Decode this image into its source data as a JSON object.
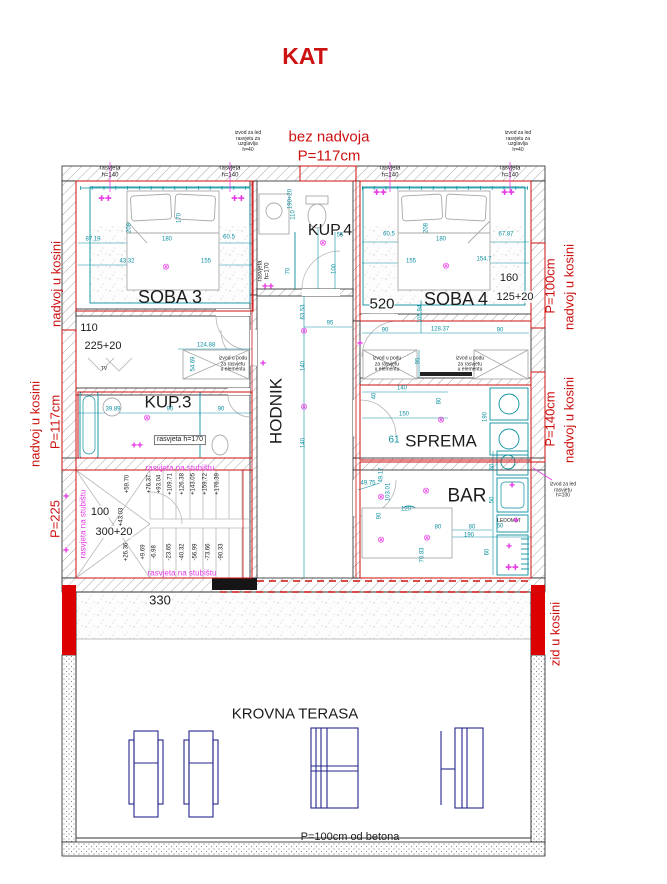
{
  "title": "KAT",
  "colors": {
    "red": "#cc1111",
    "magenta": "#e63ce6",
    "teal": "#0b8fa0",
    "navy": "#26268c",
    "black": "#1c1c1c",
    "gray": "#8c8c8c"
  },
  "icon_glyphs": {
    "ceiling": "⊗",
    "lamp": "✚✚",
    "led": "✚"
  },
  "labels": [
    {
      "name": "plan-title",
      "text": "KAT",
      "x": 305,
      "y": 57,
      "s": 23,
      "c": "red",
      "w": 1
    },
    {
      "name": "bez-nadvoja-label",
      "text": "bez nadvoja",
      "x": 329,
      "y": 138,
      "s": 15,
      "c": "red"
    },
    {
      "name": "bez-nadvoja-height",
      "text": "P=117cm",
      "x": 329,
      "y": 157,
      "s": 15,
      "c": "red"
    },
    {
      "name": "nadvoj-left-upper",
      "text": "nadvoj u kosini",
      "x": 57,
      "y": 284,
      "rot": -90,
      "s": 13,
      "c": "red"
    },
    {
      "name": "nadvoj-left-mid",
      "text": "nadvoj u kosini",
      "x": 36,
      "y": 424,
      "rot": -90,
      "s": 13,
      "c": "red"
    },
    {
      "name": "nadvoj-left-mid-height",
      "text": "P=117cm",
      "x": 56,
      "y": 422,
      "rot": -90,
      "s": 13,
      "c": "red"
    },
    {
      "name": "p225-label",
      "text": "P=225",
      "x": 56,
      "y": 519,
      "rot": -90,
      "s": 13,
      "c": "red"
    },
    {
      "name": "nadvoj-right-upper",
      "text": "nadvoj u kosini",
      "x": 570,
      "y": 287,
      "rot": -90,
      "s": 13,
      "c": "red"
    },
    {
      "name": "nadvoj-right-upper-height",
      "text": "P=100cm",
      "x": 551,
      "y": 286,
      "rot": -90,
      "s": 13,
      "c": "red"
    },
    {
      "name": "nadvoj-right-mid",
      "text": "nadvoj u kosini",
      "x": 570,
      "y": 420,
      "rot": -90,
      "s": 13,
      "c": "red"
    },
    {
      "name": "nadvoj-right-mid-height",
      "text": "P=140cm",
      "x": 551,
      "y": 419,
      "rot": -90,
      "s": 13,
      "c": "red"
    },
    {
      "name": "zid-u-kosini-label",
      "text": "zid u kosini",
      "x": 556,
      "y": 634,
      "rot": -90,
      "s": 13,
      "c": "red"
    },
    {
      "name": "room-soba3",
      "text": "SOBA 3",
      "x": 170,
      "y": 297,
      "s": 18
    },
    {
      "name": "room-kup4",
      "text": "KUP.4",
      "x": 330,
      "y": 231,
      "s": 16
    },
    {
      "name": "room-soba4",
      "text": "SOBA 4",
      "x": 456,
      "y": 299,
      "s": 18
    },
    {
      "name": "room-hodnik",
      "text": "HODNIK",
      "x": 276,
      "y": 411,
      "rot": -90,
      "s": 17
    },
    {
      "name": "room-kup3",
      "text": "KUP.3",
      "x": 168,
      "y": 402,
      "s": 17
    },
    {
      "name": "room-sprema",
      "text": "SPREMA",
      "x": 441,
      "y": 441,
      "s": 17
    },
    {
      "name": "room-bar",
      "text": "BAR",
      "x": 467,
      "y": 496,
      "s": 19
    },
    {
      "name": "room-krovna-terasa",
      "text": "KROVNA TERASA",
      "x": 295,
      "y": 715,
      "s": 15
    },
    {
      "name": "terrace-note",
      "text": "P=100cm od betona",
      "x": 350,
      "y": 837,
      "s": 11
    },
    {
      "name": "dim-520",
      "text": "520",
      "x": 382,
      "y": 305,
      "s": 15,
      "bg": 1
    },
    {
      "name": "dim-330",
      "text": "330",
      "x": 160,
      "y": 601,
      "s": 13,
      "bg": 1
    },
    {
      "name": "dim-110",
      "text": "110",
      "x": 89,
      "y": 328,
      "s": 11,
      "bg": 1
    },
    {
      "name": "dim-225-20",
      "text": "225+20",
      "x": 103,
      "y": 346,
      "s": 11,
      "bg": 1
    },
    {
      "name": "dim-100",
      "text": "100",
      "x": 100,
      "y": 512,
      "s": 11,
      "bg": 1
    },
    {
      "name": "dim-300-20",
      "text": "300+20",
      "x": 114,
      "y": 532,
      "s": 11,
      "bg": 1
    },
    {
      "name": "dim-160",
      "text": "160",
      "x": 509,
      "y": 278,
      "s": 11,
      "bg": 1
    },
    {
      "name": "dim-125-20",
      "text": "125+20",
      "x": 515,
      "y": 297,
      "s": 11,
      "bg": 1
    },
    {
      "name": "tv-label",
      "text": "TV",
      "x": 104,
      "y": 370,
      "s": 5
    },
    {
      "name": "ledomat-label",
      "text": "LEDOMAT",
      "x": 509,
      "y": 522,
      "s": 5
    },
    {
      "name": "rasvjeta-140-1",
      "text": "rasvjeta\nh=140",
      "x": 110,
      "y": 172,
      "s": 6
    },
    {
      "name": "rasvjeta-140-2",
      "text": "rasvjeta\nh=140",
      "x": 230,
      "y": 172,
      "s": 6
    },
    {
      "name": "rasvjeta-140-3",
      "text": "rasvjeta\nh=140",
      "x": 390,
      "y": 172,
      "s": 6
    },
    {
      "name": "rasvjeta-140-4",
      "text": "rasvjeta\nh=140",
      "x": 510,
      "y": 172,
      "s": 6
    },
    {
      "name": "rasvjeta-170-kup3",
      "text": "rasvjeta h=170",
      "x": 180,
      "y": 440,
      "s": 7,
      "box": 1
    },
    {
      "name": "rasvjeta-170-kup4",
      "text": "rasvjeta\nh=170",
      "x": 264,
      "y": 271,
      "rot": -90,
      "s": 6
    },
    {
      "name": "izvod-led-uzglavlje-left",
      "text": "izvod za led\nrasvjetu za\nuzglavlja\nh=40",
      "x": 248,
      "y": 142,
      "s": 5
    },
    {
      "name": "izvod-led-uzglavlje-right",
      "text": "izvod za led\nrasvjetu za\nuzglavlja\nh=40",
      "x": 518,
      "y": 142,
      "s": 5
    },
    {
      "name": "izvod-led-h100",
      "text": "izvod za led\nrasvjetu\nh=100",
      "x": 563,
      "y": 491,
      "s": 5
    },
    {
      "name": "izvod-podu-kup3",
      "text": "izvod u podu\nza rasvjetu\nu elementu",
      "x": 233,
      "y": 365,
      "s": 5
    },
    {
      "name": "izvod-podu-soba4-left",
      "text": "izvod u podu\nza rasvjetu\nu elementu",
      "x": 387,
      "y": 365,
      "s": 5
    },
    {
      "name": "izvod-podu-soba4-right",
      "text": "izvod u podu\nza rasvjetu\nu elementu",
      "x": 470,
      "y": 365,
      "s": 5
    },
    {
      "name": "rasvjeta-stubiste-top",
      "text": "rasvjeta na stubištu",
      "x": 180,
      "y": 469,
      "s": 8,
      "c": "magenta"
    },
    {
      "name": "rasvjeta-stubiste-bottom",
      "text": "rasvjeta na stubištu",
      "x": 182,
      "y": 574,
      "s": 8,
      "c": "magenta"
    },
    {
      "name": "rasvjeta-stubiste-side",
      "text": "rasvjeta na stubištu",
      "x": 84,
      "y": 524,
      "rot": -90,
      "s": 8,
      "c": "magenta"
    },
    {
      "name": "stair-elev-top-1",
      "text": "+59.70",
      "x": 128,
      "y": 484,
      "rot": -90,
      "s": 6
    },
    {
      "name": "stair-elev-top-2",
      "text": "+76.37",
      "x": 150,
      "y": 484,
      "rot": -90,
      "s": 6
    },
    {
      "name": "stair-elev-top-3",
      "text": "+93.04",
      "x": 160,
      "y": 484,
      "rot": -90,
      "s": 6
    },
    {
      "name": "stair-elev-top-4",
      "text": "+109.71",
      "x": 171,
      "y": 484,
      "rot": -90,
      "s": 6
    },
    {
      "name": "stair-elev-top-5",
      "text": "+126.38",
      "x": 183,
      "y": 484,
      "rot": -90,
      "s": 6
    },
    {
      "name": "stair-elev-top-6",
      "text": "+143.05",
      "x": 194,
      "y": 484,
      "rot": -90,
      "s": 6
    },
    {
      "name": "stair-elev-top-7",
      "text": "+159.72",
      "x": 206,
      "y": 484,
      "rot": -90,
      "s": 6
    },
    {
      "name": "stair-elev-top-8",
      "text": "+176.39",
      "x": 218,
      "y": 484,
      "rot": -90,
      "s": 6
    },
    {
      "name": "stair-elev-mid",
      "text": "+43.03",
      "x": 122,
      "y": 517,
      "rot": -90,
      "s": 6
    },
    {
      "name": "stair-elev-bot-1",
      "text": "+26.36",
      "x": 127,
      "y": 552,
      "rot": -90,
      "s": 6
    },
    {
      "name": "stair-elev-bot-2",
      "text": "+9.69",
      "x": 144,
      "y": 552,
      "rot": -90,
      "s": 6
    },
    {
      "name": "stair-elev-bot-3",
      "text": "-6.98",
      "x": 155,
      "y": 552,
      "rot": -90,
      "s": 6
    },
    {
      "name": "stair-elev-bot-4",
      "text": "-23.65",
      "x": 170,
      "y": 552,
      "rot": -90,
      "s": 6
    },
    {
      "name": "stair-elev-bot-5",
      "text": "-40.32",
      "x": 183,
      "y": 552,
      "rot": -90,
      "s": 6
    },
    {
      "name": "stair-elev-bot-6",
      "text": "-56.99",
      "x": 196,
      "y": 552,
      "rot": -90,
      "s": 6
    },
    {
      "name": "stair-elev-bot-7",
      "text": "-73.66",
      "x": 209,
      "y": 552,
      "rot": -90,
      "s": 6
    },
    {
      "name": "stair-elev-bot-8",
      "text": "-90.33",
      "x": 222,
      "y": 552,
      "rot": -90,
      "s": 6
    },
    {
      "name": "dim-87-19",
      "text": "87.19",
      "x": 93,
      "y": 240,
      "s": 6,
      "c": "teal"
    },
    {
      "name": "dim-180-s3",
      "text": "180",
      "x": 167,
      "y": 240,
      "s": 6,
      "c": "teal"
    },
    {
      "name": "dim-60-5-s3",
      "text": "60.5",
      "x": 229,
      "y": 238,
      "s": 6,
      "c": "teal"
    },
    {
      "name": "dim-43-32",
      "text": "43.32",
      "x": 127,
      "y": 262,
      "s": 6,
      "c": "teal"
    },
    {
      "name": "dim-155-s3",
      "text": "155",
      "x": 206,
      "y": 262,
      "s": 6,
      "c": "teal"
    },
    {
      "name": "dim-208-s3",
      "text": "208",
      "x": 130,
      "y": 228,
      "rot": -90,
      "s": 6,
      "c": "teal"
    },
    {
      "name": "dim-170-s3",
      "text": "170",
      "x": 180,
      "y": 218,
      "rot": -90,
      "s": 6,
      "c": "teal"
    },
    {
      "name": "dim-60-5-s4",
      "text": "60.5",
      "x": 389,
      "y": 235,
      "s": 6,
      "c": "teal"
    },
    {
      "name": "dim-180-s4",
      "text": "180",
      "x": 441,
      "y": 240,
      "s": 6,
      "c": "teal"
    },
    {
      "name": "dim-67-87",
      "text": "67.87",
      "x": 506,
      "y": 235,
      "s": 6,
      "c": "teal"
    },
    {
      "name": "dim-155-s4",
      "text": "155",
      "x": 411,
      "y": 262,
      "s": 6,
      "c": "teal"
    },
    {
      "name": "dim-154-7",
      "text": "154.7",
      "x": 484,
      "y": 260,
      "s": 6,
      "c": "teal"
    },
    {
      "name": "dim-208-s4",
      "text": "208",
      "x": 427,
      "y": 228,
      "rot": -90,
      "s": 6,
      "c": "teal"
    },
    {
      "name": "dim-90-a",
      "text": "90",
      "x": 385,
      "y": 331,
      "s": 6,
      "c": "teal"
    },
    {
      "name": "dim-128-37",
      "text": "128.37",
      "x": 440,
      "y": 330,
      "s": 6,
      "c": "teal"
    },
    {
      "name": "dim-90-b",
      "text": "90",
      "x": 500,
      "y": 331,
      "s": 6,
      "c": "teal"
    },
    {
      "name": "dim-105-94",
      "text": "105.94",
      "x": 421,
      "y": 314,
      "rot": -90,
      "s": 6,
      "c": "teal"
    },
    {
      "name": "dim-110-kup4",
      "text": "110",
      "x": 294,
      "y": 215,
      "rot": -90,
      "s": 6,
      "c": "teal"
    },
    {
      "name": "dim-70-kup4",
      "text": "70",
      "x": 289,
      "y": 271,
      "rot": -90,
      "s": 6,
      "c": "teal"
    },
    {
      "name": "dim-100-kup4",
      "text": "100",
      "x": 335,
      "y": 269,
      "rot": -90,
      "s": 6,
      "c": "teal"
    },
    {
      "name": "dim-55-kup4",
      "text": "55",
      "x": 340,
      "y": 236,
      "s": 6,
      "c": "teal"
    },
    {
      "name": "dim-190-20-kup4",
      "text": "190+20",
      "x": 291,
      "y": 199,
      "rot": -90,
      "s": 6,
      "c": "teal"
    },
    {
      "name": "dim-63-53",
      "text": "63.53",
      "x": 304,
      "y": 312,
      "rot": -90,
      "s": 6,
      "c": "teal"
    },
    {
      "name": "dim-95-hodnik",
      "text": "95",
      "x": 330,
      "y": 324,
      "s": 6,
      "c": "teal"
    },
    {
      "name": "dim-140-h1",
      "text": "140",
      "x": 304,
      "y": 366,
      "rot": -90,
      "s": 6,
      "c": "teal"
    },
    {
      "name": "dim-140-h2",
      "text": "140",
      "x": 304,
      "y": 443,
      "rot": -90,
      "s": 6,
      "c": "teal"
    },
    {
      "name": "dim-39-89",
      "text": "39.89",
      "x": 113,
      "y": 410,
      "s": 6,
      "c": "teal"
    },
    {
      "name": "dim-90-kup3a",
      "text": "90",
      "x": 170,
      "y": 410,
      "s": 6,
      "c": "teal"
    },
    {
      "name": "dim-90-kup3b",
      "text": "90",
      "x": 221,
      "y": 410,
      "s": 6,
      "c": "teal"
    },
    {
      "name": "dim-124-88",
      "text": "124.88",
      "x": 206,
      "y": 346,
      "s": 6,
      "c": "teal"
    },
    {
      "name": "dim-54-69",
      "text": "54.69",
      "x": 194,
      "y": 364,
      "rot": -90,
      "s": 6,
      "c": "teal"
    },
    {
      "name": "dim-95-sprema",
      "text": "95",
      "x": 419,
      "y": 361,
      "rot": -90,
      "s": 6,
      "c": "teal"
    },
    {
      "name": "dim-140-sprema",
      "text": "140",
      "x": 402,
      "y": 389,
      "s": 6,
      "c": "teal"
    },
    {
      "name": "dim-40-sprema",
      "text": "40",
      "x": 375,
      "y": 396,
      "rot": -90,
      "s": 6,
      "c": "teal"
    },
    {
      "name": "dim-80-sprema",
      "text": "80",
      "x": 440,
      "y": 401,
      "rot": -90,
      "s": 6,
      "c": "teal"
    },
    {
      "name": "dim-150-sprema",
      "text": "150",
      "x": 404,
      "y": 415,
      "s": 6,
      "c": "teal"
    },
    {
      "name": "dim-190-sprema",
      "text": "190",
      "x": 486,
      "y": 417,
      "rot": -90,
      "s": 6,
      "c": "teal"
    },
    {
      "name": "dim-61-sprema",
      "text": "61",
      "x": 394,
      "y": 440,
      "s": 10,
      "c": "teal"
    },
    {
      "name": "dim-49-75",
      "text": "49.75",
      "x": 368,
      "y": 484,
      "s": 6,
      "c": "teal"
    },
    {
      "name": "dim-49-17",
      "text": "49.17",
      "x": 382,
      "y": 475,
      "rot": -90,
      "s": 6,
      "c": "teal"
    },
    {
      "name": "dim-103-01",
      "text": "103.01",
      "x": 389,
      "y": 492,
      "rot": -90,
      "s": 6,
      "c": "teal"
    },
    {
      "name": "dim-120-bar",
      "text": "120",
      "x": 406,
      "y": 510,
      "s": 6,
      "c": "teal"
    },
    {
      "name": "dim-90-bar",
      "text": "90",
      "x": 380,
      "y": 516,
      "rot": -90,
      "s": 6,
      "c": "teal"
    },
    {
      "name": "dim-80-bar-a",
      "text": "80",
      "x": 438,
      "y": 528,
      "s": 6,
      "c": "teal"
    },
    {
      "name": "dim-80-bar-b",
      "text": "80",
      "x": 472,
      "y": 528,
      "s": 6,
      "c": "teal"
    },
    {
      "name": "dim-190-bar",
      "text": "190",
      "x": 469,
      "y": 536,
      "s": 6,
      "c": "teal"
    },
    {
      "name": "dim-70-83",
      "text": "70.83",
      "x": 423,
      "y": 555,
      "rot": -90,
      "s": 6,
      "c": "teal"
    },
    {
      "name": "dim-60-ledomat",
      "text": "60",
      "x": 500,
      "y": 527,
      "s": 6,
      "c": "teal"
    },
    {
      "name": "dim-60-col-a",
      "text": "60",
      "x": 493,
      "y": 467,
      "rot": -90,
      "s": 6,
      "c": "teal"
    },
    {
      "name": "dim-50-col",
      "text": "50",
      "x": 493,
      "y": 500,
      "rot": -90,
      "s": 6,
      "c": "teal"
    },
    {
      "name": "dim-60-col-b",
      "text": "60",
      "x": 488,
      "y": 552,
      "rot": -90,
      "s": 6,
      "c": "teal"
    }
  ],
  "icons": [
    {
      "name": "bed-lamp-icon",
      "g": "lamp",
      "x": 105,
      "y": 199,
      "s": 8
    },
    {
      "name": "bed-lamp-icon",
      "g": "lamp",
      "x": 238,
      "y": 199,
      "s": 8
    },
    {
      "name": "bed-lamp-icon",
      "g": "lamp",
      "x": 380,
      "y": 193,
      "s": 8
    },
    {
      "name": "bed-lamp-icon",
      "g": "lamp",
      "x": 508,
      "y": 193,
      "s": 8
    },
    {
      "name": "ceiling-light-icon",
      "g": "ceiling",
      "x": 166,
      "y": 267,
      "s": 9
    },
    {
      "name": "ceiling-light-icon",
      "g": "ceiling",
      "x": 446,
      "y": 266,
      "s": 9
    },
    {
      "name": "ceiling-light-icon",
      "g": "ceiling",
      "x": 323,
      "y": 243,
      "s": 9
    },
    {
      "name": "ceiling-light-icon",
      "g": "ceiling",
      "x": 304,
      "y": 331,
      "s": 9
    },
    {
      "name": "ceiling-light-icon",
      "g": "ceiling",
      "x": 304,
      "y": 407,
      "s": 9
    },
    {
      "name": "ceiling-light-icon",
      "g": "ceiling",
      "x": 147,
      "y": 418,
      "s": 9
    },
    {
      "name": "ceiling-light-icon",
      "g": "ceiling",
      "x": 441,
      "y": 420,
      "s": 9
    },
    {
      "name": "ceiling-light-icon",
      "g": "ceiling",
      "x": 381,
      "y": 497,
      "s": 9
    },
    {
      "name": "ceiling-light-icon",
      "g": "ceiling",
      "x": 426,
      "y": 491,
      "s": 9
    },
    {
      "name": "ceiling-light-icon",
      "g": "ceiling",
      "x": 381,
      "y": 540,
      "s": 9
    },
    {
      "name": "ceiling-light-icon",
      "g": "ceiling",
      "x": 427,
      "y": 538,
      "s": 9
    },
    {
      "name": "led-outlet-icon",
      "g": "led",
      "x": 66,
      "y": 497,
      "s": 7
    },
    {
      "name": "led-outlet-icon",
      "g": "led",
      "x": 66,
      "y": 551,
      "s": 7
    },
    {
      "name": "led-outlet-icon",
      "g": "led",
      "x": 263,
      "y": 364,
      "s": 7
    },
    {
      "name": "led-outlet-icon",
      "g": "led",
      "x": 360,
      "y": 344,
      "s": 7
    },
    {
      "name": "mirror-light-icon",
      "g": "lamp",
      "x": 268,
      "y": 287,
      "s": 7
    },
    {
      "name": "mirror-light-icon",
      "g": "lamp",
      "x": 137,
      "y": 446,
      "s": 7
    },
    {
      "name": "led-outlet-icon",
      "g": "led",
      "x": 512,
      "y": 486,
      "s": 7
    },
    {
      "name": "led-outlet-icon",
      "g": "led",
      "x": 516,
      "y": 521,
      "s": 7
    },
    {
      "name": "led-outlet-icon",
      "g": "led",
      "x": 509,
      "y": 547,
      "s": 7
    },
    {
      "name": "bar-light-icon",
      "g": "lamp",
      "x": 512,
      "y": 568,
      "s": 8
    }
  ]
}
